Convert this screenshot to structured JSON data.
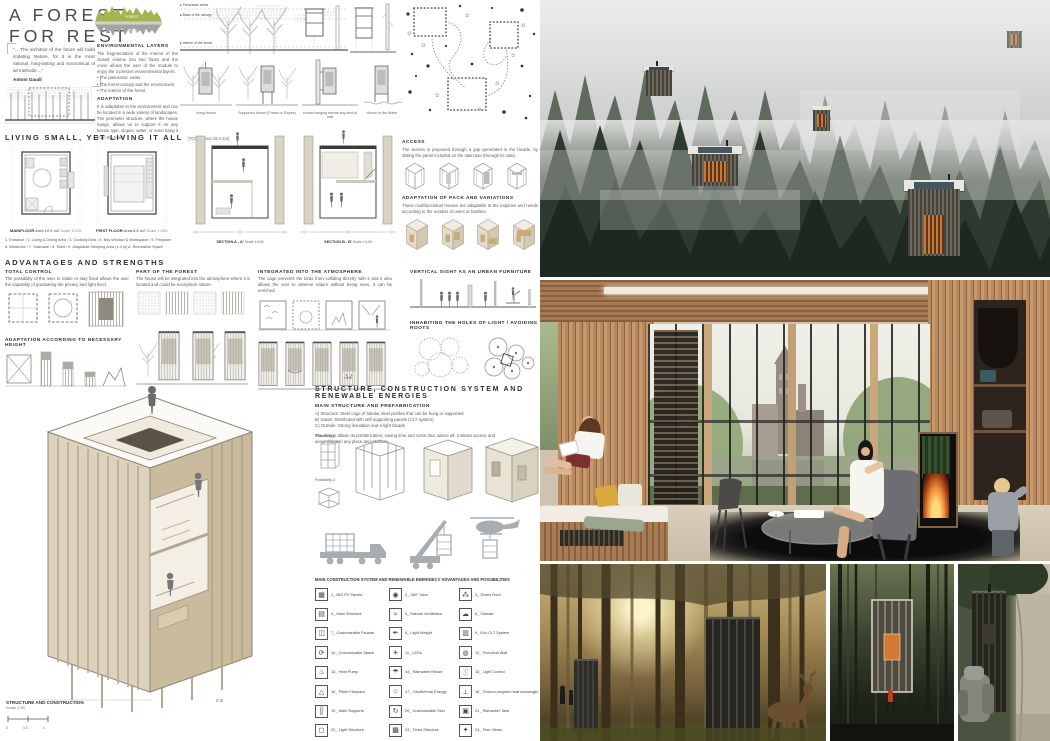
{
  "palette": {
    "accent_olive": "#a9b253",
    "ink": "#3a3a3a",
    "draw_gray": "#9a9a9a",
    "wood": "#b8895f",
    "forest_dark": "#24332a",
    "fire_orange": "#d97b3a"
  },
  "header": {
    "title_line1": "A  FOREST",
    "title_line2": "FOR  REST",
    "quote_text": "“... The architect of the future will build imitating Nature, for it is the most rational, long-lasting and economical of all methods ...”",
    "quote_author": "Antoni Gaudí"
  },
  "histogram": {
    "label_top": "FOREST",
    "label_bottom": "REST"
  },
  "env": {
    "title": "ENVIRONMENTAL LAYERS",
    "intro": "The fragmentation of the interior of the closed volume into two floors and the cover allows the user of the module to enjoy the 3 present environmental layers:",
    "bullets": [
      "• The panoramic views",
      "• The forest canopy and the environment",
      "• The interior of the forest"
    ],
    "adapt_title": "ADAPTATION",
    "adapt_text": "It is adaptable to the environment and can be located in a wide variety of landscapes. The perimeter structure, where the house hangs, allows us to support it on any terrain type, slopes, water, or even hang it from the trees."
  },
  "layers_diagram": {
    "labels": [
      "Panoramic views",
      "Base of the canopy",
      "Interior of the forest"
    ]
  },
  "variants": [
    "Hung House",
    "Supported House (Forest or Slopes)",
    "House hanging beside any kind of wall",
    "House in the Water"
  ],
  "living": {
    "title": "LIVING SMALL, YET LIVING IT ALL",
    "title_suffix": "(TOTAL Area 19,3 m2)",
    "plan1_name": "MAINFLOOR",
    "plan1_area": "Area 10,5 m2",
    "plan1_scale": "Scale 1/100",
    "plan2_name": "FIRST FLOOR",
    "plan2_area": "Area 8,8 m2",
    "plan2_scale": "Scale 1/100",
    "legend_line1": "1. Entrance  /  2. Living & Dining Area  /  3. Cooking Area  /  4. Bay Window & Workspace  /  5. Fireplace",
    "legend_line2": "6. Wardrobe  /  7. Staircase  /  8. Toilet  /  9. Adaptable Sleeping Area (1-3 pl)  A. Recreation Space",
    "sectionA": "SECTION A - A'",
    "sectionA_scale": "Scale 1/100",
    "sectionB": "SECTION B - B'",
    "sectionB_scale": "Scale 1/100"
  },
  "access": {
    "title": "ACCESS",
    "text": "The access is proposed through a gap generated in the facade, by sliding the panel included on the staircase (through its rails)."
  },
  "pack": {
    "title": "ADAPTATION OF PACK AND VARIATIONS",
    "text": "These multifunctional houses are adaptable to the inquiries and needs according to the number of users or families."
  },
  "adv": {
    "title": "ADVANTAGES AND STRENGTHS",
    "tc_title": "TOTAL CONTROL",
    "tc_text": "The possibility of the user to rotate or stay fixed allows the user the capability of graduating the privacy and light level.",
    "height_title": "ADAPTATION ACCORDING TO NECESSARY HEIGHT",
    "forest_title": "PART OF THE FOREST",
    "forest_text": "The house will be integrated into the atmosphere where it is located and could be ecosystem nature.",
    "atm_title": "INTEGRATED INTO THE ATMOSPHERE",
    "atm_text": "The cage prevents the birds from colliding directly with it and it also allows the user to observe nature without being seen, it can be enriched.",
    "vert_title": "VERTICAL SIGHT AS AN URBAN FURNITURE",
    "holes_title": "INHABITING THE HOLES OF LIGHT / AVOIDING ROOTS"
  },
  "axo": {
    "label": "STRUCTURE AND CONSTRUCTION",
    "scale": "Scale 1:50",
    "bar0": "0",
    "bar1": "0.5",
    "bar2": "1",
    "dim": "2 m"
  },
  "structure": {
    "title": "STRUCTURE, CONSTRUCTION SYSTEM AND RENEWABLE ENERGIES",
    "sub1": "MAIN STRUCTURE AND PREFABRICATION",
    "line_a": "A) Structure: Steel cage of tubular steel profiles that can be hung or supported",
    "line_b": "B) Inside: Distributed with self-supporting panels (CLT system)",
    "line_c": "C) Outside: Strong insulation and a light facade",
    "para": "The design allows its prefabrication, saving time and costs. But, above all, it allows access and assemblage in any place and situation.",
    "poss1": "Possibility 1",
    "poss2": "Possibility 2",
    "sub2": "MAIN CONSTRUCTION SYSTEM AND RENEWABLE ENERGIES // ADVANTAGES AND POSSIBILITIES"
  },
  "legend": {
    "items": [
      {
        "glyph": "▦",
        "label": "1_ BIO PV Panels"
      },
      {
        "glyph": "◉",
        "label": "2_ 360° View"
      },
      {
        "glyph": "⁂",
        "label": "3_ Green Roof"
      },
      {
        "glyph": "▤",
        "label": "4_ Main Structure"
      },
      {
        "glyph": "≈",
        "label": "5_ Natural Ventilation"
      },
      {
        "glyph": "☁",
        "label": "6_ Climate"
      },
      {
        "glyph": "◫",
        "label": "7_ Customizable Facade"
      },
      {
        "glyph": "✒",
        "label": "8_ Light Weight"
      },
      {
        "glyph": "▥",
        "label": "9_ Eco CLT System"
      },
      {
        "glyph": "⟳",
        "label": "10_ Customizable Space"
      },
      {
        "glyph": "☀",
        "label": "11_ LEDs"
      },
      {
        "glyph": "◍",
        "label": "12_ Technical Wall"
      },
      {
        "glyph": "♨",
        "label": "13_ Heat Pump"
      },
      {
        "glyph": "☂",
        "label": "14_ Rainwater Reuse"
      },
      {
        "glyph": "░",
        "label": "15_ Light Control"
      },
      {
        "glyph": "△",
        "label": "16_ Pellet Fireplace"
      },
      {
        "glyph": "⌂",
        "label": "17_ Geothermal Energy"
      },
      {
        "glyph": "⊥",
        "label": "18_ Ground-coupled heat exchanger"
      },
      {
        "glyph": "║",
        "label": "19_ Main Supports"
      },
      {
        "glyph": "↻",
        "label": "20_ Customizable Skin"
      },
      {
        "glyph": "▣",
        "label": "21_ Rainwater Tank"
      },
      {
        "glyph": "◻",
        "label": "22_ Light Structure"
      },
      {
        "glyph": "▩",
        "label": "23_ Fixed Structure"
      },
      {
        "glyph": "✦",
        "label": "24_ Free Views"
      }
    ]
  }
}
